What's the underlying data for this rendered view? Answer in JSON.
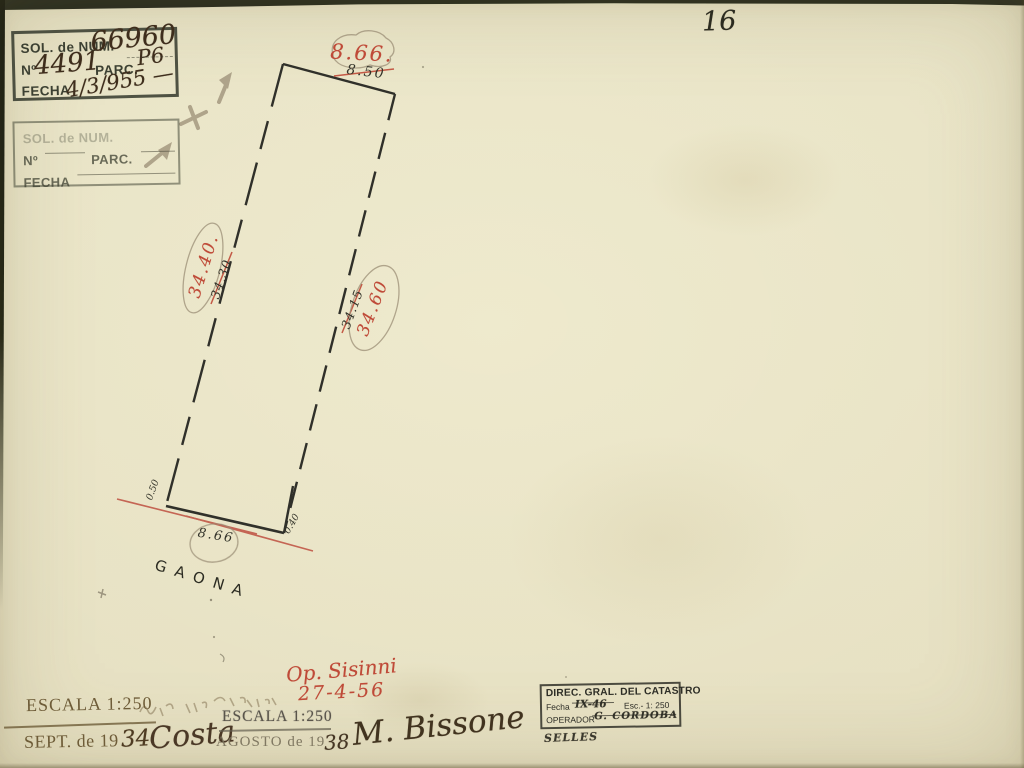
{
  "page": {
    "number": "16"
  },
  "parcel": {
    "street": "GAONA",
    "front_new": "8.66.",
    "front_old": "8.50",
    "left_new": "34.40.",
    "left_old": "34.30",
    "right_new": "34.60",
    "right_old": "34.15",
    "rear": "8.66",
    "offset_left": "0.50",
    "offset_right": "0.40",
    "op_name": "Op. Sisinni",
    "op_date": "27-4-56"
  },
  "stamp_sol_filled": {
    "l1": "SOL. de NUM.",
    "v1": "66960",
    "l2a": "Nº",
    "v2a": "4491",
    "l2b": "PARC.",
    "v2b": "P6",
    "l3": "FECHA",
    "v3": "4/3/955 —"
  },
  "stamp_sol_blank": {
    "l1": "SOL. de NUM.",
    "l2a": "Nº",
    "l2b": "PARC.",
    "l3": "FECHA"
  },
  "stamp_1934": {
    "escala": "ESCALA 1:250",
    "date_prefix": "SEPT. de 19",
    "date_year": "34",
    "signature": "Costa"
  },
  "stamp_1938": {
    "escala": "ESCALA 1:250",
    "date_prefix": "AGOSTO de 19",
    "date_year": "38",
    "signature": "M. Bissone"
  },
  "stamp_catastro": {
    "title": "DIREC. GRAL. DEL CATASTRO",
    "fecha_label": "Fecha",
    "fecha_value": "IX-46",
    "esc_label": "Esc.- 1: 250",
    "operador_label": "OPERADOR",
    "operador_value": "G. CORDOBA",
    "selles": "SELLES"
  },
  "colors": {
    "paper": "#e8e3c6",
    "ink": "#30302a",
    "red_ink": "#bf4a38",
    "pencil": "#9b8e76",
    "stamp_brown": "#6e5c38"
  }
}
